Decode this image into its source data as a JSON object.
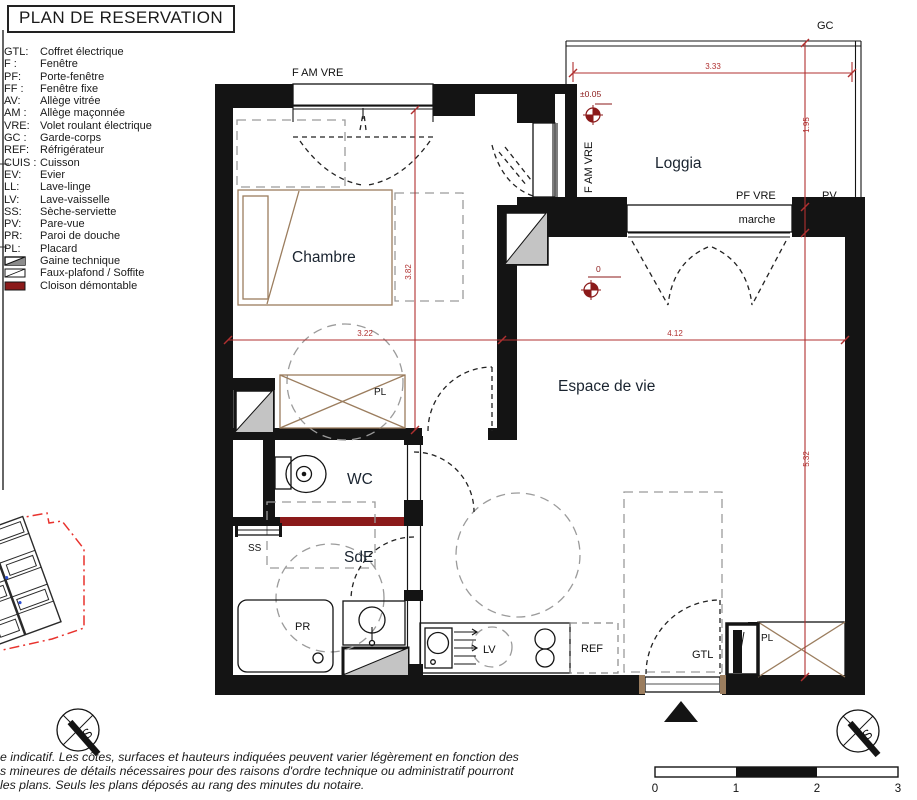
{
  "title": "PLAN DE RESERVATION",
  "legend": {
    "items": [
      {
        "abbr": "GTL:",
        "label": "Coffret électrique"
      },
      {
        "abbr": "F :",
        "label": "Fenêtre"
      },
      {
        "abbr": "PF:",
        "label": "Porte-fenêtre"
      },
      {
        "abbr": "FF :",
        "label": "Fenêtre fixe"
      },
      {
        "abbr": "AV:",
        "label": "Allège vitrée"
      },
      {
        "abbr": "AM :",
        "label": "Allège maçonnée"
      },
      {
        "abbr": "VRE:",
        "label": "Volet roulant électrique"
      },
      {
        "abbr": "GC :",
        "label": "Garde-corps"
      },
      {
        "abbr": "REF:",
        "label": "Réfrigérateur"
      },
      {
        "abbr": "CUIS :",
        "label": "Cuisson"
      },
      {
        "abbr": "EV:",
        "label": "Evier"
      },
      {
        "abbr": "LL:",
        "label": "Lave-linge"
      },
      {
        "abbr": "LV:",
        "label": "Lave-vaisselle"
      },
      {
        "abbr": "SS:",
        "label": "Sèche-serviette"
      },
      {
        "abbr": "PV:",
        "label": "Pare-vue"
      },
      {
        "abbr": "PR:",
        "label": "Paroi de douche"
      },
      {
        "abbr": "PL:",
        "label": "Placard"
      }
    ],
    "symbols": [
      {
        "label": "Gaine technique"
      },
      {
        "label": "Faux-plafond / Soffite"
      },
      {
        "label": "Cloison démontable"
      }
    ]
  },
  "rooms": {
    "chambre": "Chambre",
    "loggia": "Loggia",
    "espace": "Espace de vie",
    "wc": "WC",
    "sde": "SdE"
  },
  "plan_labels": {
    "f_am_vre_top": "F AM VRE",
    "f_am_vre_side": "F AM VRE",
    "gc": "GC",
    "pf_vre": "PF VRE",
    "pv": "PV",
    "marche": "marche",
    "pl_chambre": "PL",
    "pl_entree": "PL",
    "ss": "SS",
    "pr": "PR",
    "lv": "LV",
    "ref": "REF",
    "gtl": "GTL"
  },
  "dimensions": {
    "d333": "3.33",
    "d195": "1.95",
    "d382": "3.82",
    "d322": "3.22",
    "d412": "4.12",
    "d532": "5.32"
  },
  "levels": {
    "loggia": "±0.05",
    "espace": "0"
  },
  "scale_bar": {
    "t0": "0",
    "t1": "1",
    "t2": "2",
    "t3": "3"
  },
  "compass": {
    "letter": "S"
  },
  "disclaimer": {
    "line1": "e indicatif. Les côtes, surfaces et hauteurs indiquées peuvent varier légèrement en fonction des",
    "line2": "s mineures de détails nécessaires pour des raisons d'ordre technique ou administratif pourront",
    "line3": "les plans. Seuls les plans déposés au rang des minutes du notaire."
  },
  "colors": {
    "dim_red": "#b03030",
    "dark_red": "#8b1a1a",
    "tan": "#9b7d5e",
    "site_red": "#e8322d",
    "gaine_gray": "#c4c4c4",
    "dash_gray": "#9b9b9b",
    "ink": "#141414"
  }
}
